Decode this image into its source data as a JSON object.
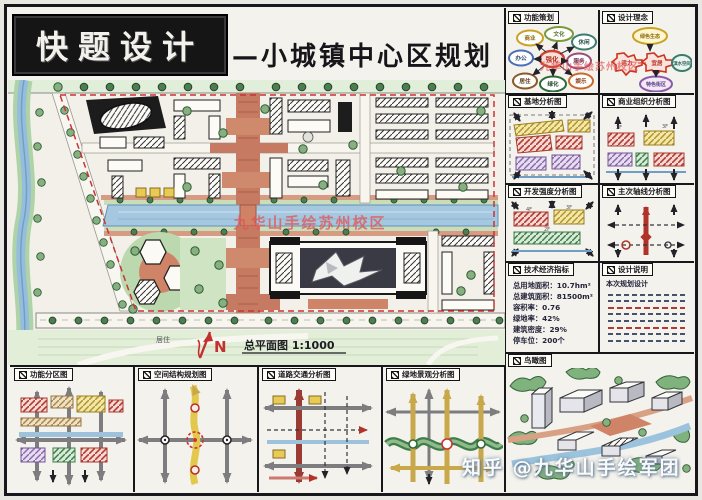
{
  "header": {
    "logo_text": "快题设计",
    "title": "—小城镇中心区规划"
  },
  "watermarks": {
    "plan_center": "九华山手绘苏州校区",
    "panels_top_right": "九华山手绘苏州校区",
    "bottom_credit": "知乎 @九华山手绘军团"
  },
  "plan": {
    "scale_label": "总平面图 1:1000",
    "north_label": "N",
    "zone_label": "居住"
  },
  "right_panels": {
    "concept_left": {
      "title": "功能策划",
      "center": "强化",
      "bubbles": [
        "商业",
        "文化",
        "休闲",
        "办公",
        "服务",
        "居住",
        "绿化",
        "娱乐"
      ]
    },
    "concept_right": {
      "title": "设计理念",
      "bubbles": [
        "绿色生态",
        "活力",
        "宜居",
        "滨水空间",
        "特色街区"
      ]
    },
    "site_analysis": {
      "title": "基地分析图"
    },
    "business": {
      "title": "商业组织分析图",
      "labels": [
        "2F",
        "3F"
      ]
    },
    "intensity": {
      "title": "开发强度分析图",
      "labels": [
        "4F",
        "3F",
        "2F"
      ]
    },
    "axis": {
      "title": "主次轴线分析图"
    },
    "indicators": {
      "title": "技术经济指标",
      "items": [
        "总用地面积：10.7hm²",
        "总建筑面积：81500m²",
        "容积率：0.76",
        "绿地率：42%",
        "建筑密度：29%",
        "停车位：200个"
      ]
    },
    "notes": {
      "title": "设计说明",
      "intro": "本次规划设计"
    },
    "birdseye": {
      "title": "鸟瞰图"
    }
  },
  "bottom_panels": [
    {
      "title": "功能分区图"
    },
    {
      "title": "空间结构规划图"
    },
    {
      "title": "道路交通分析图"
    },
    {
      "title": "绿地景观分析图"
    }
  ],
  "colors": {
    "paper": "#f4f2ec",
    "ink": "#17171c",
    "road_paving": "#c57a61",
    "water": "#96bddb",
    "tree_green": "#86b07e",
    "field_green": "#e2eed8",
    "accent_red": "#cc3333",
    "axis_yellow": "#e2c94e"
  }
}
